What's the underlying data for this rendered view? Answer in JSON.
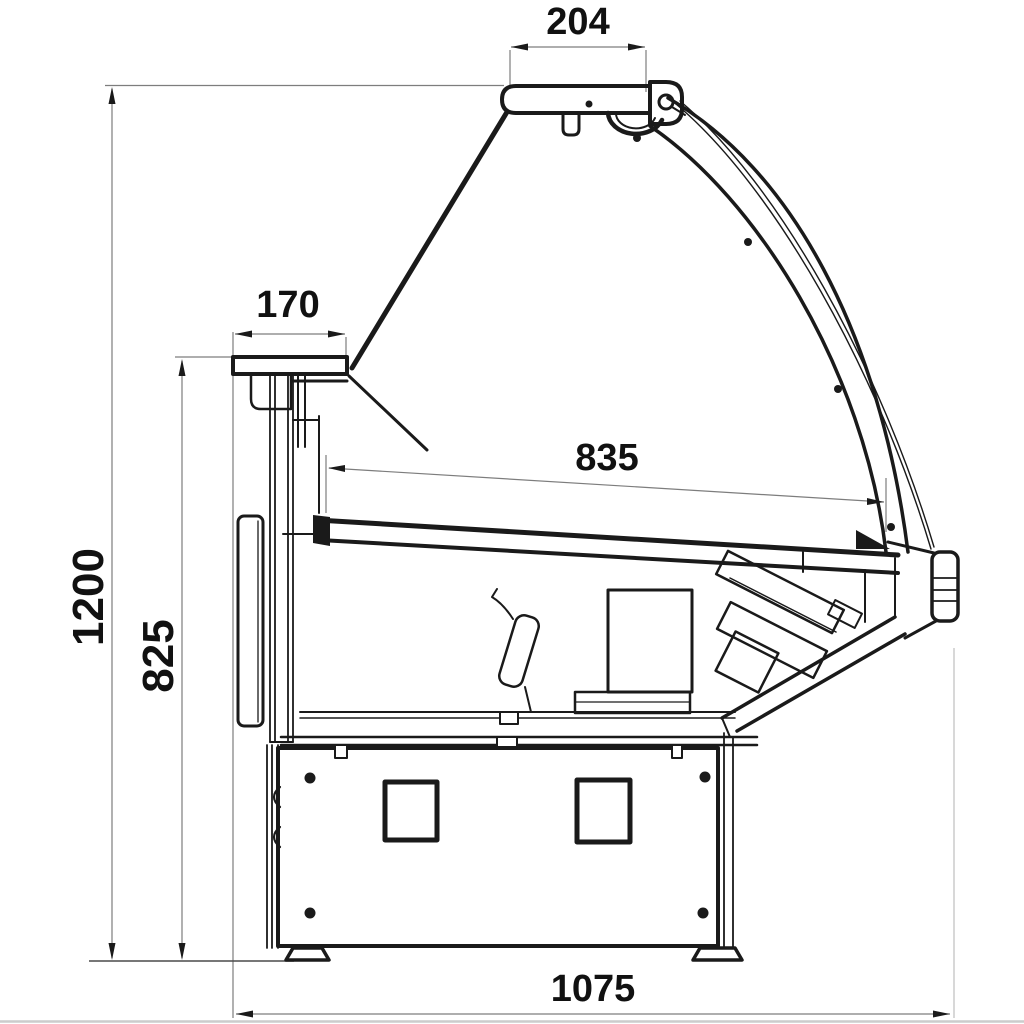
{
  "drawing": {
    "type": "technical-section-drawing",
    "units": "mm",
    "colors": {
      "line": "#1a1a1a",
      "dim_line": "#7d7d7d",
      "floor_line": "#4a4a4a",
      "page_edge": "#cccccc",
      "background": "#ffffff"
    },
    "dimensions": {
      "canopy_top_width": "204",
      "rear_counter_depth": "170",
      "display_deck_depth": "835",
      "overall_height": "1200",
      "rear_counter_height": "825",
      "overall_depth": "1075"
    }
  }
}
